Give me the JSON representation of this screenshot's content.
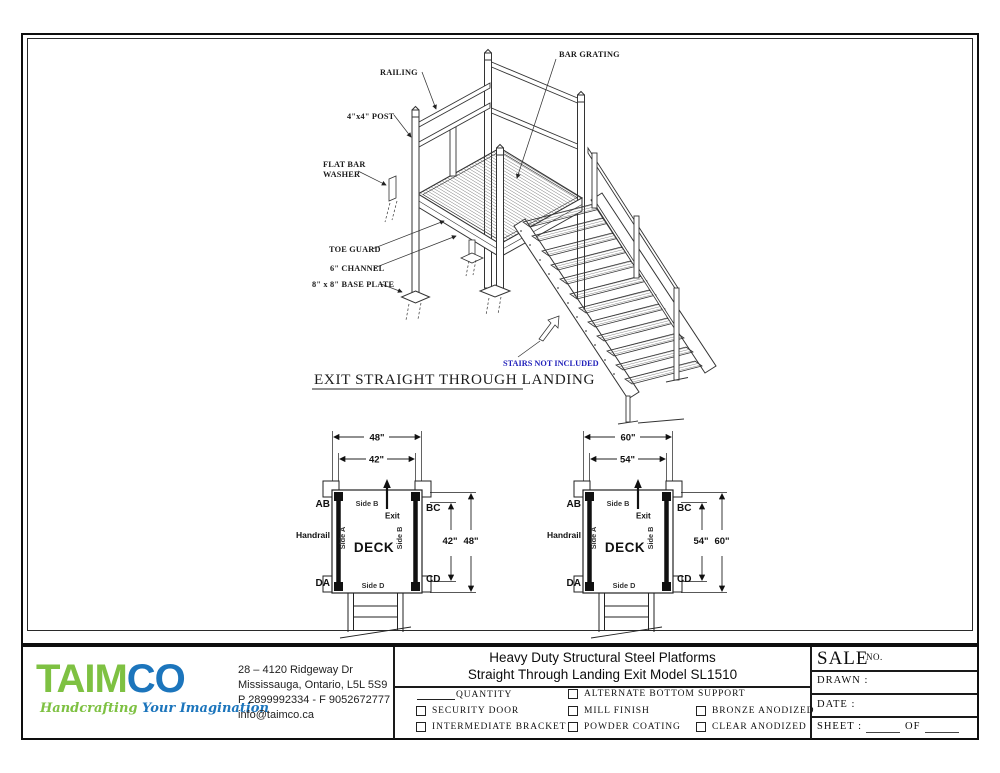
{
  "colors": {
    "note_blue": "#2323bb",
    "logo_green": "#7ec142",
    "logo_blue": "#1c75bc",
    "line": "#1a1a1a"
  },
  "drawing": {
    "labels": {
      "bar_grating": "BAR GRATING",
      "railing": "RAILING",
      "post": "4\"x4\" POST",
      "flat_bar_line1": "FLAT BAR",
      "flat_bar_line2": "WASHER",
      "toe_guard": "TOE GUARD",
      "channel": "6\" CHANNEL",
      "base_plate": "8\" x 8\" BASE PLATE",
      "stairs_note": "STAIRS NOT INCLUDED"
    },
    "caption": "EXIT STRAIGHT THROUGH LANDING"
  },
  "decks": [
    {
      "outer_width": "48\"",
      "inner_width": "42\"",
      "inner_height": "42\"",
      "outer_height": "48\"",
      "corner_ab": "AB",
      "corner_bc": "BC",
      "corner_da": "DA",
      "corner_cd": "CD",
      "handrail": "Handrail",
      "side_top": "Side B",
      "side_left": "Side A",
      "side_right": "Side B",
      "side_bottom": "Side D",
      "deck_label": "DECK",
      "exit_label": "Exit"
    },
    {
      "outer_width": "60\"",
      "inner_width": "54\"",
      "inner_height": "54\"",
      "outer_height": "60\"",
      "corner_ab": "AB",
      "corner_bc": "BC",
      "corner_da": "DA",
      "corner_cd": "CD",
      "handrail": "Handrail",
      "side_top": "Side B",
      "side_left": "Side A",
      "side_right": "Side B",
      "side_bottom": "Side D",
      "deck_label": "DECK",
      "exit_label": "Exit"
    }
  ],
  "title_block": {
    "logo": {
      "text_green": "TAIM",
      "text_blue": "CO",
      "tagline_green": "Handcrafting",
      "tagline_blue": "Your Imagination"
    },
    "address_line1": "28 – 4120 Ridgeway Dr",
    "address_line2": "Mississauga, Ontario, L5L 5S9",
    "address_line3": "P 2899992334 - F 9052672777",
    "address_line4": "info@taimco.ca",
    "title_line1": "Heavy Duty Structural Steel Platforms",
    "title_line2": "Straight Through Landing Exit  Model SL1510",
    "options": {
      "quantity_label": "QUANTITY",
      "row1_col2": "ALTERNATE BOTTOM SUPPORT",
      "row2_col1": "SECURITY DOOR",
      "row2_col2": "MILL FINISH",
      "row2_col3": "BRONZE ANODIZED",
      "row3_col1": "INTERMEDIATE BRACKET",
      "row3_col2": "POWDER COATING",
      "row3_col3": "CLEAR ANODIZED"
    },
    "sale_panel": {
      "sale": "SALE",
      "no": "NO.",
      "drawn": "DRAWN :",
      "date": "DATE :",
      "sheet": "SHEET :",
      "of": "OF"
    }
  }
}
